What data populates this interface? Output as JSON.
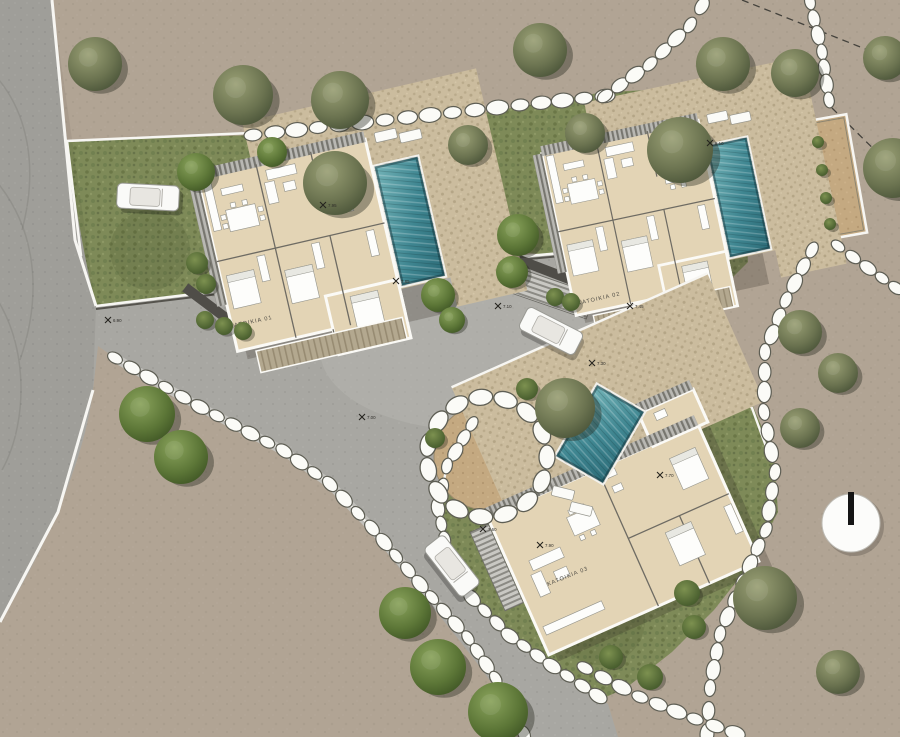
{
  "scene": {
    "type": "architectural-site-plan",
    "width": 900,
    "height": 737
  },
  "palette": {
    "dirt": "#b1a494",
    "road": "#a8a7a2",
    "road_light": "#b6b5b0",
    "grass": "#7e8a58",
    "tree_green": "#5c7637",
    "tree_olive": "#6b7350",
    "pool": "#3f8691",
    "pool_dark": "#2c6b77",
    "terrace": "#cbbc9e",
    "floor": "#e3d4b5",
    "wall_dark": "#4f4d48",
    "stone_fill": "#fbfbf7",
    "stone_line": "#5e5e54",
    "circle_dirt": "#c4a981",
    "pad": "#c7a878",
    "white_line": "#f7f6f2"
  },
  "labels": {
    "residence_1": "ΚΑΤΟΙΚΙΑ 01",
    "residence_2": "ΚΑΤΟΙΚΙΑ 02",
    "residence_3": "ΚΑΤΟΙΚΙΑ 03"
  },
  "elevation_markers": [
    {
      "x": 108,
      "y": 320,
      "v": "6.90"
    },
    {
      "x": 323,
      "y": 205,
      "v": "7.95"
    },
    {
      "x": 396,
      "y": 281,
      "v": "7.85"
    },
    {
      "x": 498,
      "y": 306,
      "v": "7.10"
    },
    {
      "x": 710,
      "y": 143,
      "v": "8.10"
    },
    {
      "x": 630,
      "y": 306,
      "v": "7.45"
    },
    {
      "x": 592,
      "y": 363,
      "v": "7.30"
    },
    {
      "x": 540,
      "y": 545,
      "v": "7.90"
    },
    {
      "x": 483,
      "y": 529,
      "v": "7.60"
    },
    {
      "x": 362,
      "y": 417,
      "v": "7.00"
    },
    {
      "x": 660,
      "y": 475,
      "v": "7.70"
    }
  ],
  "cars": [
    {
      "x": 148,
      "y": 197,
      "rot": 3
    },
    {
      "x": 551,
      "y": 331,
      "rot": 27
    },
    {
      "x": 452,
      "y": 566,
      "rot": 52
    }
  ],
  "landscape": {
    "trees": [
      [
        95,
        64,
        27,
        "o"
      ],
      [
        243,
        95,
        30,
        "o"
      ],
      [
        340,
        100,
        29,
        "o"
      ],
      [
        540,
        50,
        27,
        "o"
      ],
      [
        723,
        64,
        27,
        "o"
      ],
      [
        795,
        73,
        24,
        "o"
      ],
      [
        885,
        58,
        22,
        "o"
      ],
      [
        893,
        168,
        30,
        "o"
      ],
      [
        196,
        172,
        19,
        "g"
      ],
      [
        272,
        152,
        15,
        "g"
      ],
      [
        335,
        183,
        32,
        "o"
      ],
      [
        468,
        145,
        20,
        "o"
      ],
      [
        585,
        133,
        20,
        "o"
      ],
      [
        680,
        150,
        33,
        "o"
      ],
      [
        518,
        235,
        21,
        "g"
      ],
      [
        512,
        272,
        16,
        "g"
      ],
      [
        438,
        295,
        17,
        "g"
      ],
      [
        452,
        320,
        13,
        "g"
      ],
      [
        147,
        414,
        28,
        "g"
      ],
      [
        181,
        457,
        27,
        "g"
      ],
      [
        565,
        408,
        30,
        "o"
      ],
      [
        800,
        332,
        22,
        "o"
      ],
      [
        838,
        373,
        20,
        "o"
      ],
      [
        800,
        428,
        20,
        "o"
      ],
      [
        405,
        613,
        26,
        "g"
      ],
      [
        438,
        667,
        28,
        "g"
      ],
      [
        498,
        712,
        30,
        "g"
      ],
      [
        765,
        598,
        32,
        "o"
      ],
      [
        838,
        672,
        22,
        "o"
      ]
    ],
    "bushes": [
      [
        197,
        263,
        11
      ],
      [
        206,
        284,
        10
      ],
      [
        205,
        320,
        9
      ],
      [
        224,
        326,
        9
      ],
      [
        243,
        331,
        9
      ],
      [
        555,
        297,
        9
      ],
      [
        571,
        302,
        9
      ],
      [
        818,
        142,
        6
      ],
      [
        822,
        170,
        6
      ],
      [
        826,
        198,
        6
      ],
      [
        830,
        224,
        6
      ],
      [
        687,
        593,
        13
      ],
      [
        694,
        627,
        12
      ],
      [
        650,
        677,
        13
      ],
      [
        611,
        657,
        12
      ],
      [
        527,
        389,
        11
      ],
      [
        435,
        438,
        10
      ]
    ],
    "stone_chains": [
      {
        "p": [
          [
            253,
            135
          ],
          [
            340,
            125
          ],
          [
            430,
            115
          ],
          [
            520,
            105
          ],
          [
            605,
            96
          ]
        ],
        "s": 9,
        "line": false,
        "band": false
      },
      {
        "p": [
          [
            605,
            96
          ],
          [
            650,
            64
          ],
          [
            690,
            25
          ],
          [
            702,
            6
          ]
        ],
        "s": 8.5,
        "line": false,
        "band": false
      },
      {
        "p": [
          [
            810,
            2
          ],
          [
            822,
            52
          ],
          [
            829,
            100
          ]
        ],
        "s": 8,
        "line": false,
        "band": false
      },
      {
        "p": [
          [
            812,
            250
          ],
          [
            786,
            300
          ],
          [
            765,
            352
          ],
          [
            764,
            412
          ],
          [
            775,
            472
          ],
          [
            766,
            530
          ],
          [
            742,
            582
          ],
          [
            720,
            634
          ],
          [
            710,
            688
          ],
          [
            707,
            734
          ]
        ],
        "s": 8.5,
        "line": false,
        "band": false
      },
      {
        "p": [
          [
            585,
            668
          ],
          [
            640,
            697
          ],
          [
            695,
            719
          ],
          [
            735,
            733
          ]
        ],
        "s": 8.5,
        "line": false,
        "band": false
      },
      {
        "p": [
          [
            472,
            424
          ],
          [
            447,
            466
          ],
          [
            438,
            508
          ],
          [
            448,
            556
          ],
          [
            472,
            598
          ],
          [
            510,
            636
          ],
          [
            552,
            666
          ],
          [
            598,
            696
          ]
        ],
        "s": 8,
        "line": true,
        "band": false
      },
      {
        "p": [
          [
            115,
            358
          ],
          [
            200,
            407
          ],
          [
            284,
            451
          ],
          [
            330,
            484
          ],
          [
            372,
            528
          ],
          [
            420,
            584
          ],
          [
            468,
            638
          ],
          [
            505,
            692
          ],
          [
            524,
            734
          ]
        ],
        "s": 8,
        "line": true,
        "band": true
      },
      {
        "p": [
          [
            838,
            246
          ],
          [
            868,
            268
          ],
          [
            896,
            288
          ]
        ],
        "s": 7.5,
        "line": false,
        "band": false
      }
    ],
    "circle_plaza": {
      "cx": 487,
      "cy": 457,
      "r": 53,
      "ring_r": 60,
      "ring_count": 15
    }
  },
  "compass": {
    "cx": 851,
    "cy": 523,
    "r": 29
  }
}
